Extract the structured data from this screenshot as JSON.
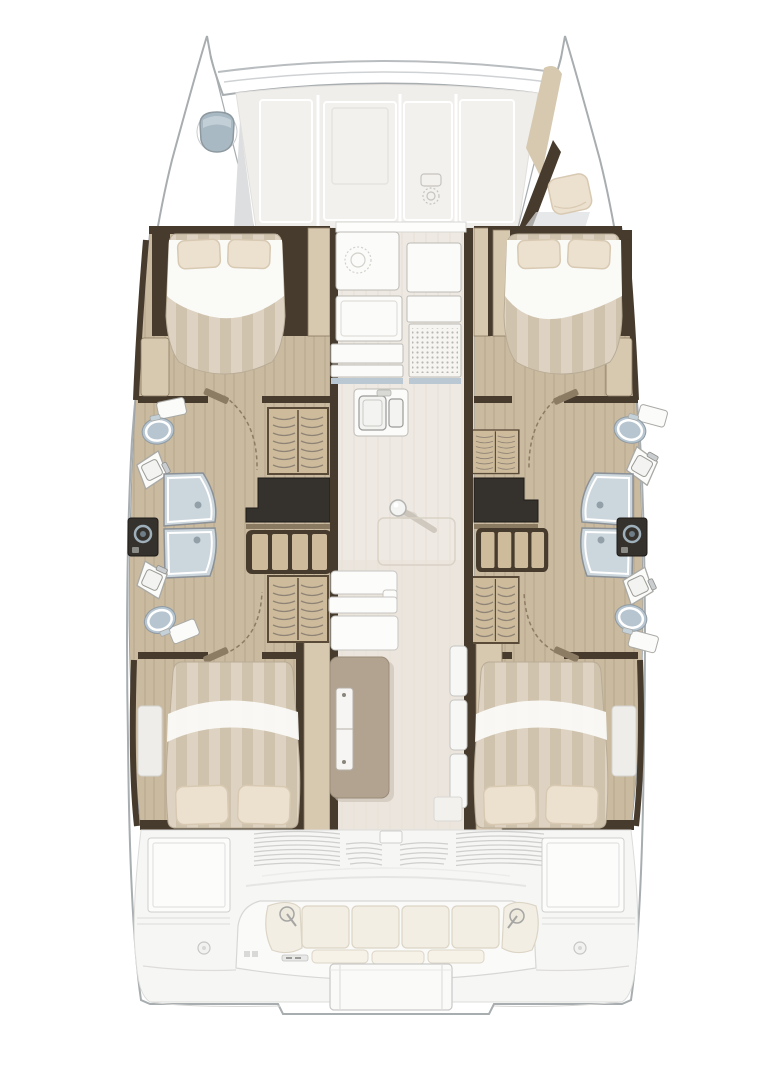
{
  "colors": {
    "hull_fill": "#ffffff",
    "hull_stroke": "#a8adb0",
    "beam_stroke": "#b9bdc0",
    "beam_stroke2": "#cfd2d4",
    "deck_panel": "#f0eeeb",
    "deck_panel2": "#f3f1ee",
    "deck_inner": "#e6e4df",
    "deck_glyph": "#c6c4bf",
    "shade_gray": "#dcdee0",
    "hatch_blue": "#a9b9c4",
    "hatch_hi": "#c5d1d9",
    "wood_floor": "#c9baa0",
    "wood_plank_line": "#b3a287",
    "wood_light": "#d6c9b0",
    "wood_edge": "#8a7a62",
    "wall_dark": "#473b2d",
    "locker_wood": "#cdbb9c",
    "locker_frame": "#5a4b38",
    "locker_rib": "#8f8375",
    "charcoal": "#35322d",
    "charcoal_edge": "#1e1c19",
    "shelf_brown": "#8a7a62",
    "counter_white": "#fbfbfa",
    "counter_stroke": "#bcbbb6",
    "counter_edge_blue": "#b9c8d3",
    "stove_face": "#f6f5f2",
    "stove_dot": "#b9b7b2",
    "basin_fill": "#f3f3f1",
    "basin_stroke": "#9a9a96",
    "shower_glass": "#ccd6dd",
    "shower_stroke": "#8b9196",
    "knob_gray": "#93a0a8",
    "porcelain": "#fbfbfa",
    "porcelain_stroke": "#a9a9a5",
    "toilet_bowl": "#b6c5d0",
    "toilet_bowl_stroke": "#8f9aa2",
    "washer_ring": "#9fb0bb",
    "bed_sheet": "#fafaf7",
    "duvet_a": "#ded3c2",
    "duvet_b": "#d0c3ae",
    "bed_stroke": "#b9ac97",
    "pillow": "#ece1cf",
    "pillow_stroke": "#d8c9b2",
    "salon_floor": "#eee9e2",
    "salon_stripe": "#e6e0d6",
    "salon_floor_aft": "#e9e2d8",
    "bulkhead_white": "#fdfdfc",
    "table_wood": "#b2a390",
    "table_stroke": "#9a8c78",
    "table_shadow": "#cdc5b8",
    "ghost_line": "#d9d2c6",
    "mast_ball": "#f4f4f2",
    "door_swing": "#8d7c64",
    "steps_white": "#f7f7f5",
    "steps_stroke": "#c5c5c2",
    "cockpit_bg": "#f6f6f5",
    "cockpit_line": "#cfcfcd",
    "cockpit_soft": "#e5e5e3",
    "cushion": "#f3eee3",
    "cushion_stroke": "#dcd5c6",
    "seat_pad": "#f6f2e8",
    "box_white": "#fcfcfb",
    "platform_white": "#fafaf9"
  }
}
